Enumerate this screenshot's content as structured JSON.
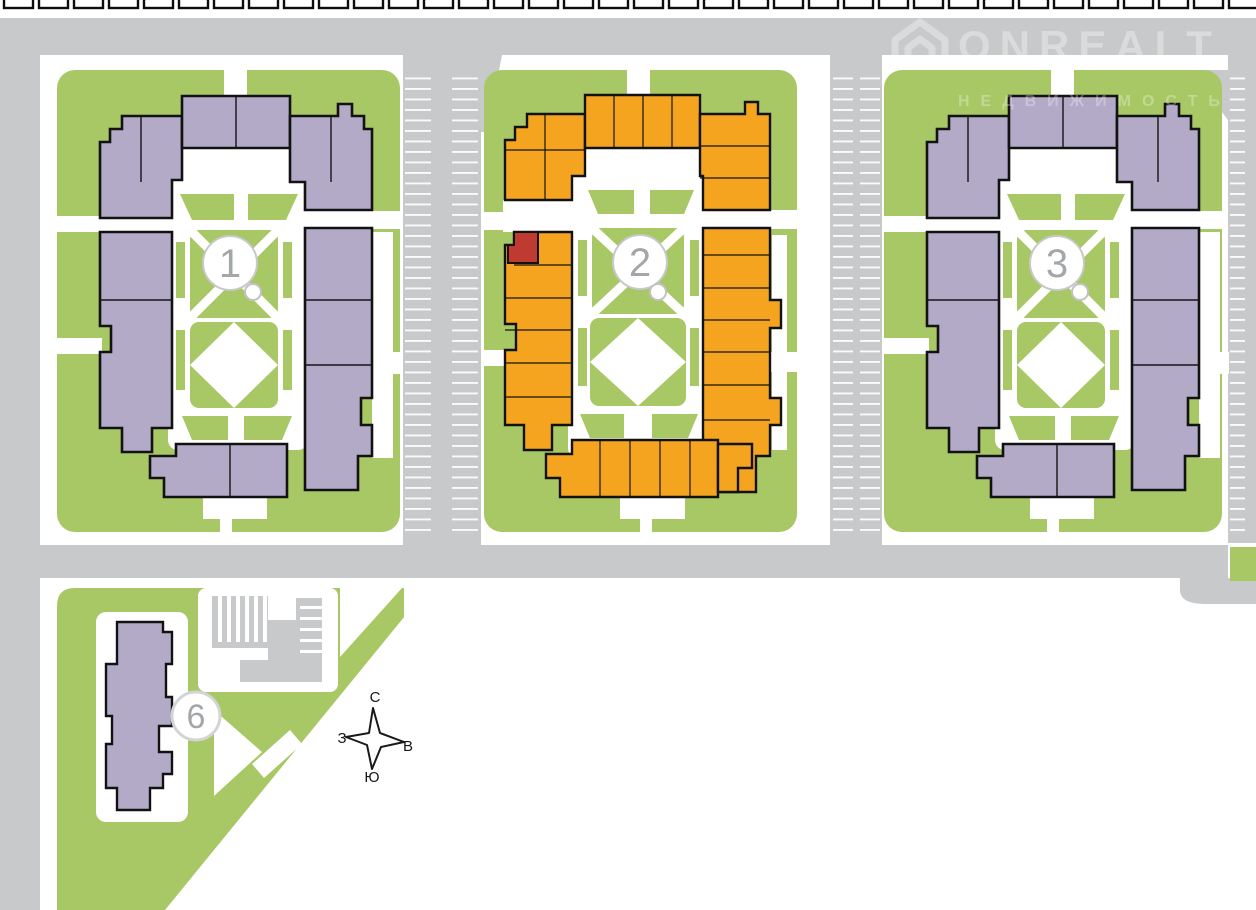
{
  "watermark": {
    "brand": "ONREALT",
    "subtitle": "НЕДВИЖИМОСТЬ"
  },
  "buildings": [
    {
      "id": "building-1",
      "label": "1",
      "state": "default"
    },
    {
      "id": "building-2",
      "label": "2",
      "state": "highlighted"
    },
    {
      "id": "building-3",
      "label": "3",
      "state": "default"
    },
    {
      "id": "building-6",
      "label": "6",
      "state": "default"
    }
  ],
  "selected_unit": {
    "building": "2",
    "color": "#bf3a31"
  },
  "compass": {
    "north": "С",
    "east": "В",
    "south": "Ю",
    "west": "З"
  },
  "colors": {
    "road": "#c7c9cb",
    "lawn": "#a8c765",
    "building_default": "#b3aac7",
    "building_highlight": "#f5a41f",
    "unit_selected": "#bf3a31",
    "outline": "#121212",
    "circle_border": "#c6c8ca",
    "circle_number": "#a3a7aa"
  }
}
